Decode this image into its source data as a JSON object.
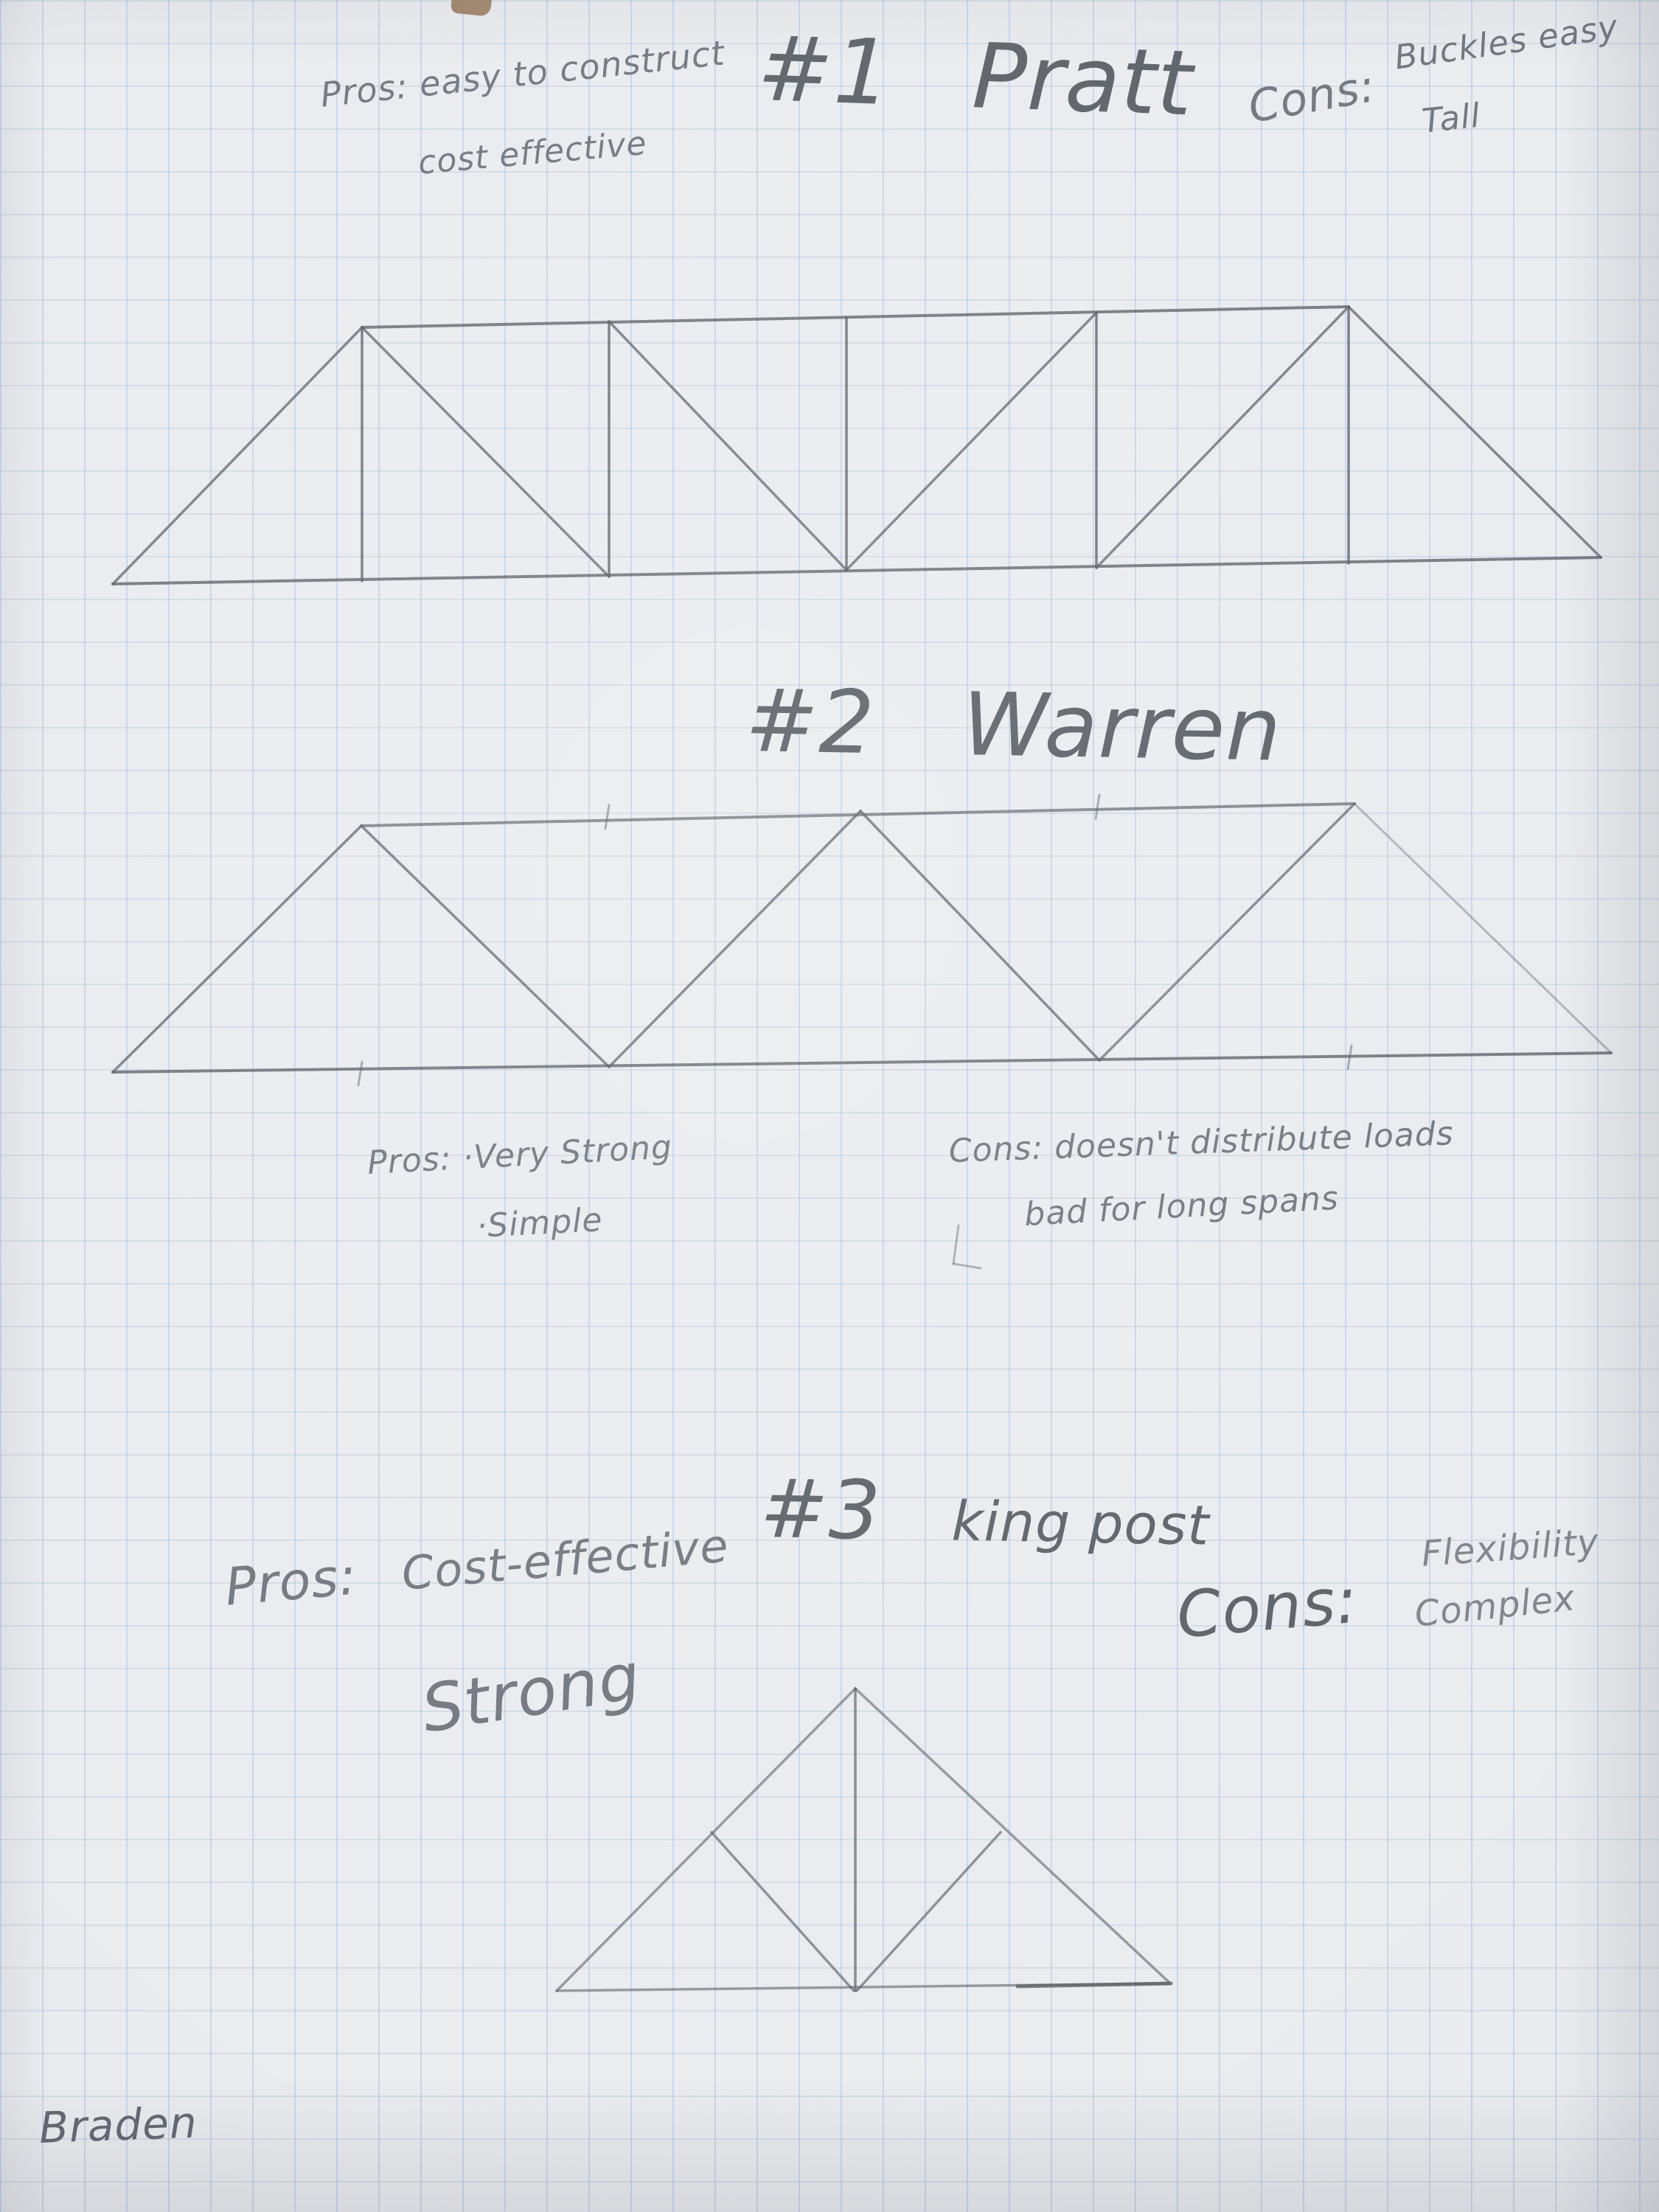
{
  "page": {
    "paper_color": "#e9ebee",
    "grid_color": "#7da5d4",
    "pencil_color": "#565b62"
  },
  "sections": [
    {
      "number": "#1",
      "title": "Pratt",
      "pros_label": "Pros:",
      "pros_lines": [
        "easy to construct",
        "cost effective"
      ],
      "cons_label": "Cons:",
      "cons_lines": [
        "Buckles easy",
        "Tall"
      ]
    },
    {
      "number": "#2",
      "title": "Warren",
      "pros_label": "Pros:",
      "pros_lines": [
        "·Very Strong",
        "·Simple"
      ],
      "cons_label": "Cons:",
      "cons_lines": [
        "doesn't distribute loads",
        "bad for long spans"
      ]
    },
    {
      "number": "#3",
      "title": "king post",
      "pros_label": "Pros:",
      "pros_lines": [
        "Cost-effective",
        "Strong"
      ],
      "cons_label": "Cons:",
      "cons_lines": [
        "Flexibility",
        "Complex"
      ]
    }
  ],
  "signature": "Braden",
  "trusses": {
    "pratt": {
      "segments": [
        [
          153,
          792,
          2171,
          756,
          0.8,
          4
        ],
        [
          491,
          444,
          1829,
          416,
          0.8,
          4
        ],
        [
          491,
          444,
          491,
          788,
          0.8,
          3.5
        ],
        [
          826,
          436,
          826,
          782,
          0.8,
          3.5
        ],
        [
          1148,
          431,
          1148,
          774,
          0.8,
          3.5
        ],
        [
          1487,
          424,
          1487,
          770,
          0.8,
          3.5
        ],
        [
          1829,
          416,
          1829,
          764,
          0.8,
          3.5
        ],
        [
          153,
          792,
          491,
          444,
          0.75,
          3.5
        ],
        [
          491,
          444,
          826,
          782,
          0.75,
          3.5
        ],
        [
          826,
          436,
          1148,
          773,
          0.75,
          3.5
        ],
        [
          1148,
          773,
          1487,
          424,
          0.75,
          3.5
        ],
        [
          1487,
          770,
          1829,
          416,
          0.75,
          3.5
        ],
        [
          1829,
          416,
          2171,
          756,
          0.75,
          3.5
        ]
      ]
    },
    "warren": {
      "segments": [
        [
          153,
          1454,
          2185,
          1428,
          0.8,
          4
        ],
        [
          490,
          1120,
          1837,
          1090,
          0.7,
          4
        ],
        [
          153,
          1454,
          490,
          1120,
          0.75,
          3.5
        ],
        [
          490,
          1120,
          826,
          1447,
          0.75,
          3.5
        ],
        [
          826,
          1447,
          1167,
          1100,
          0.75,
          3.5
        ],
        [
          1167,
          1100,
          1491,
          1438,
          0.75,
          3.5
        ],
        [
          1491,
          1438,
          1837,
          1090,
          0.7,
          3.5
        ],
        [
          1837,
          1090,
          2185,
          1428,
          0.4,
          3
        ],
        [
          826,
          1092,
          821,
          1124,
          0.5,
          3
        ],
        [
          1491,
          1078,
          1486,
          1110,
          0.5,
          3
        ],
        [
          491,
          1440,
          486,
          1472,
          0.5,
          3
        ],
        [
          1833,
          1418,
          1828,
          1450,
          0.5,
          3
        ]
      ]
    },
    "kingpost": {
      "segments": [
        [
          755,
          2700,
          1160,
          2290,
          0.6,
          3.5
        ],
        [
          1160,
          2290,
          1585,
          2688,
          0.6,
          3.5
        ],
        [
          755,
          2700,
          1585,
          2690,
          0.6,
          3.5
        ],
        [
          1380,
          2694,
          1588,
          2690,
          0.8,
          5
        ],
        [
          1160,
          2290,
          1160,
          2700,
          0.7,
          3.5
        ],
        [
          965,
          2485,
          1158,
          2700,
          0.65,
          3.5
        ],
        [
          1357,
          2485,
          1162,
          2700,
          0.65,
          3.5
        ]
      ]
    },
    "marks": {
      "segments": [
        [
          1300,
          1662,
          1293,
          1714,
          0.45,
          3
        ],
        [
          1293,
          1714,
          1330,
          1720,
          0.45,
          3
        ]
      ]
    }
  }
}
